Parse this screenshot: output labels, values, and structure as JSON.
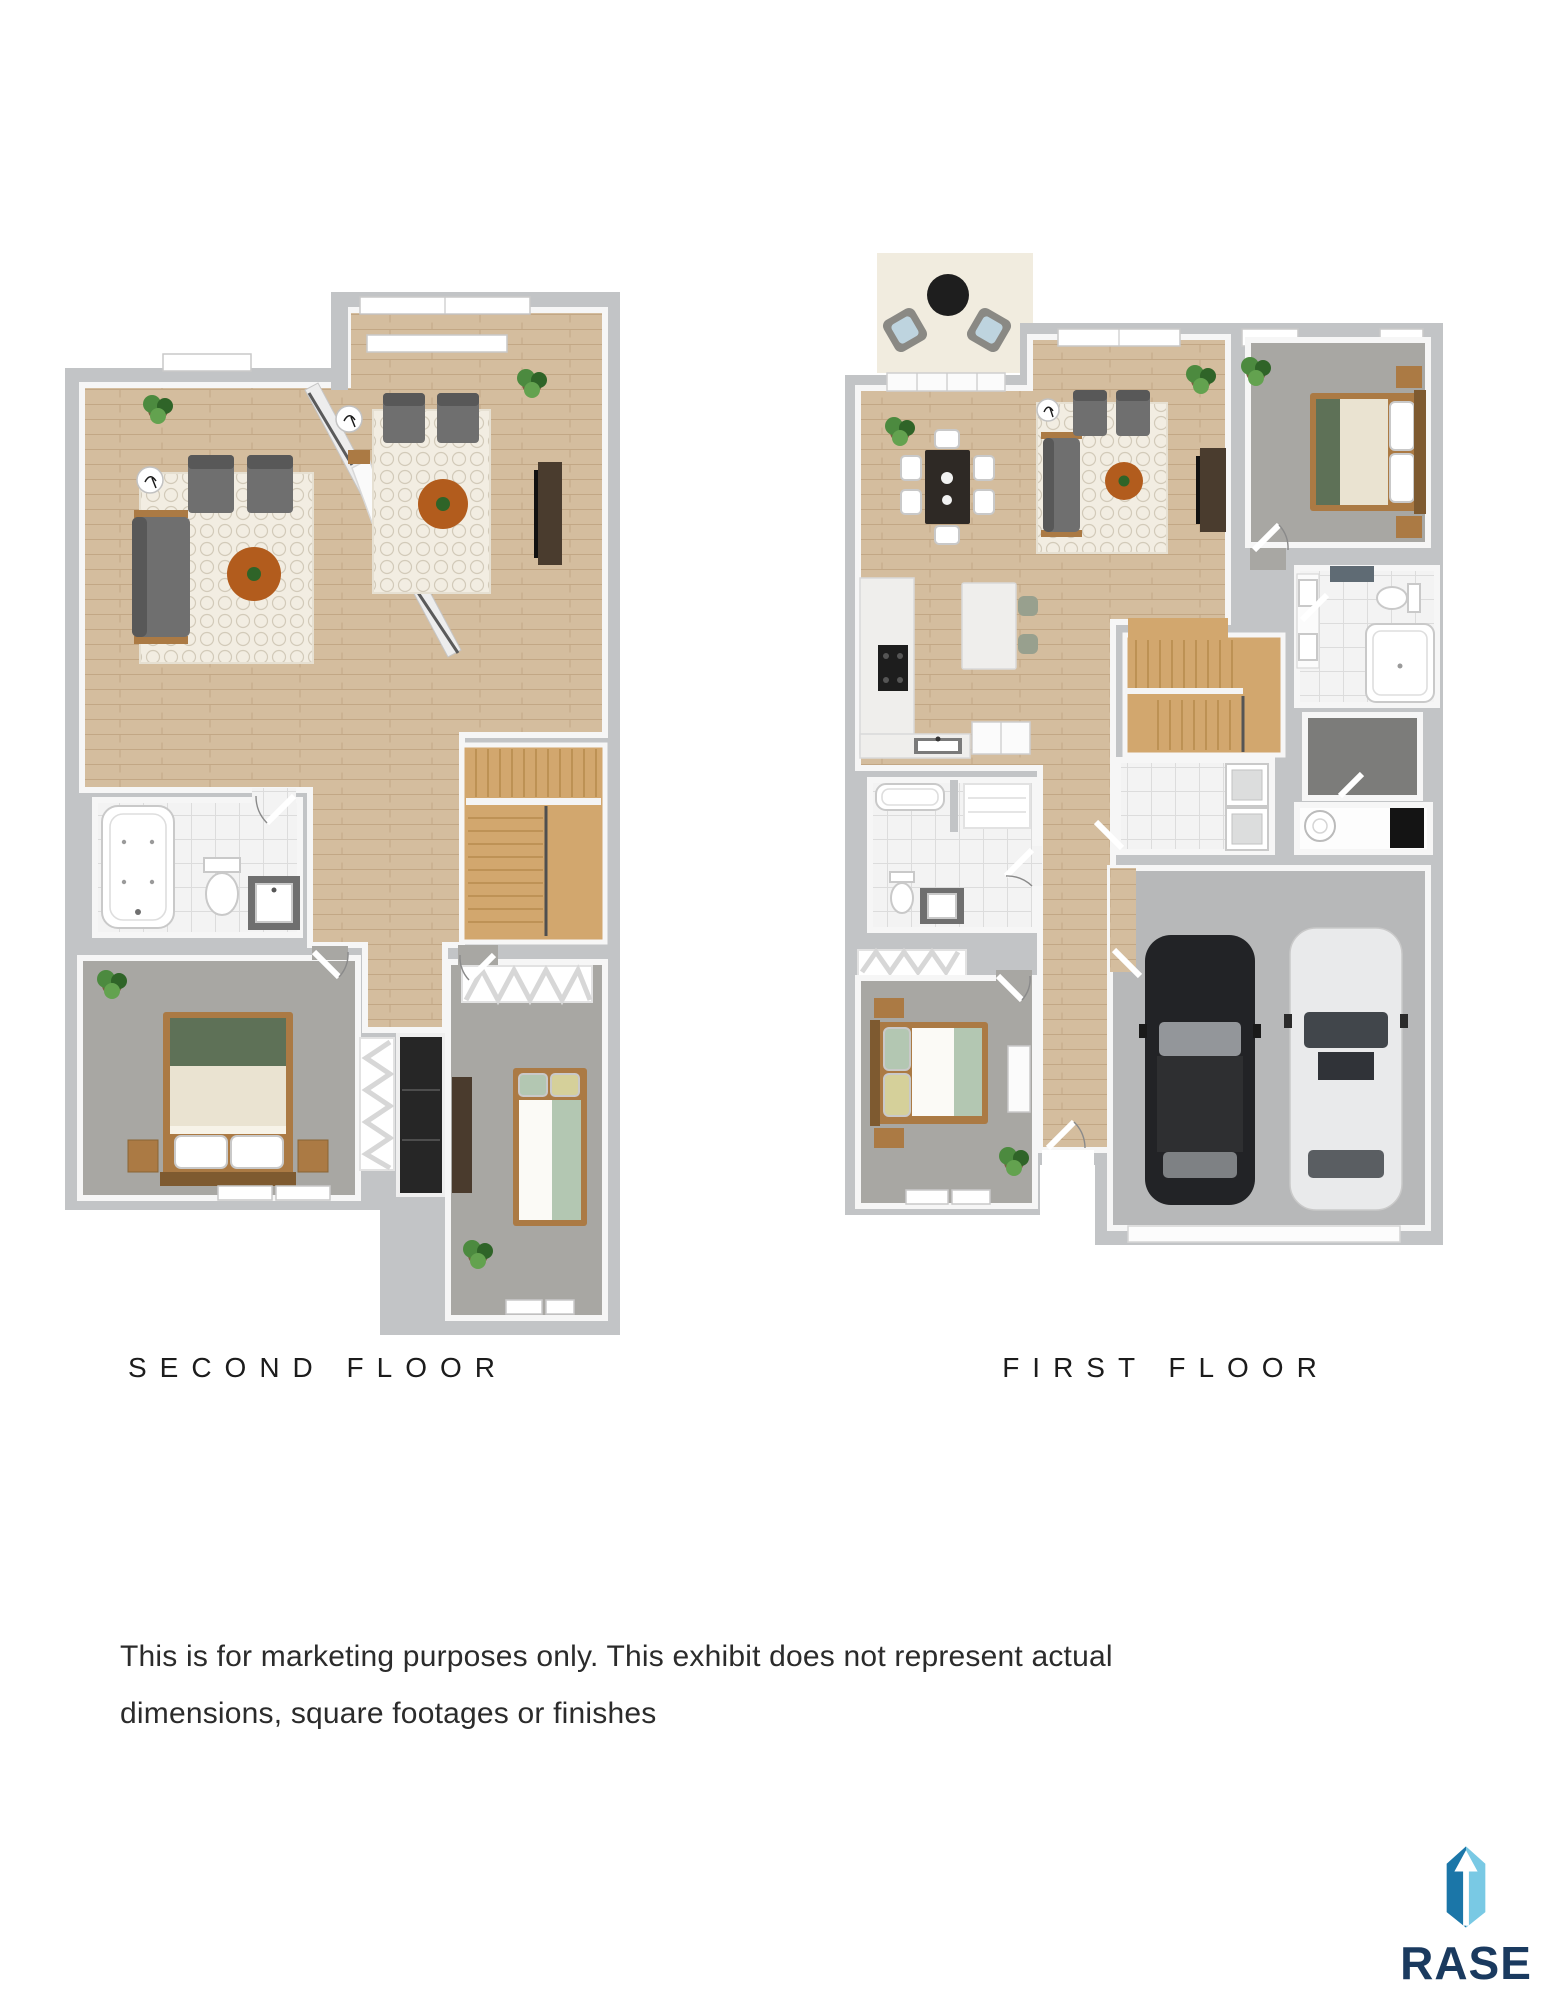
{
  "plans": {
    "second": {
      "label": "SECOND FLOOR"
    },
    "first": {
      "label": "FIRST FLOOR"
    }
  },
  "disclaimer": {
    "line1": "This is for marketing purposes only. This exhibit does not represent actual",
    "line2": "dimensions, square footages or finishes"
  },
  "logo": {
    "wordmark": "RASE"
  },
  "theme": {
    "wall": "#c2c4c6",
    "face": "#f6f6f6",
    "wood": "#d4bd9e",
    "woodLine": "#c2a785",
    "stair": "#d2a76e",
    "stairLine": "#b88c4e",
    "carpet": "#a8a7a3",
    "tile": "#f3f3f3",
    "tileLine": "#dcdcdc",
    "rug": "#f2ede2",
    "rugLine": "#d2cab9",
    "sofa": "#6f6f6f",
    "sofaDark": "#585858",
    "furnWood": "#ab7a44",
    "furnWoodDark": "#7e5a30",
    "tableWood": "#b25c1d",
    "accentGreen": "#5e7157",
    "sage": "#b3c7b2",
    "strawPillow": "#d5d09a",
    "cream": "#eae3d1",
    "plant": "#4c8a3f",
    "plantDark": "#2f6428",
    "pot": "#7d5f41",
    "patio": "#f1ecdf",
    "concrete": "#b7b8b9",
    "carBlack": "#222326",
    "carGlass": "#93969a",
    "carWhite": "#e9eaeb",
    "carWhiteGlass": "#41464b",
    "counter": "#efeeec",
    "applianceFace": "#dcdddd",
    "blueCushion": "#bed4df",
    "windowFrame": "#c9c9c9",
    "doorArc": "#8a8a8a",
    "labelText": "#1c1c1c",
    "bodyText": "#2b2b2b",
    "logoDark": "#1b76a8",
    "logoLight": "#79c9e4",
    "logoNavy": "#1a3a5f"
  }
}
